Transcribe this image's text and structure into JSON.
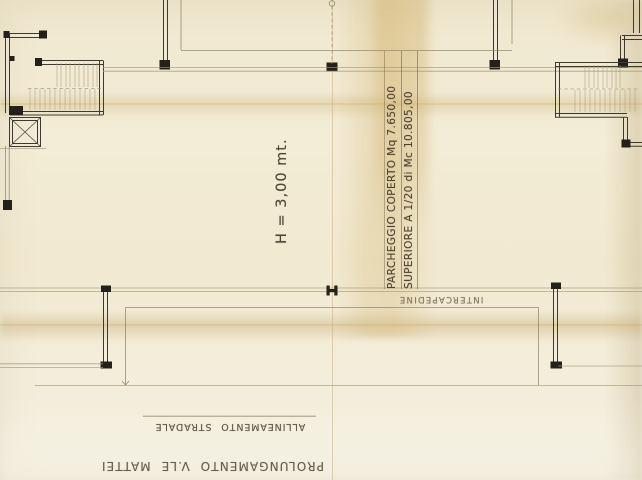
{
  "annotations": {
    "height_note": "H = 3,00 mt.",
    "parking_note": {
      "line1": "PARCHEGGIO COPERTO Mq 7.650,00",
      "line2": "SUPERIORE A 1/20 di Mc 10.805,00"
    },
    "cavity_label": "INTERCAPEDINE",
    "street_alignment_label": "ALLINEAMENTO STRADALE",
    "extension_label": "PROLUNGAMENTO V.LE MATTEI"
  },
  "colors": {
    "paper": "#f2ebd4",
    "ink": "#3c3a32",
    "ink_dark": "#23211c",
    "pencil": "#a29878",
    "pencil_medium": "#8d8468",
    "handwriting": "#4c4536",
    "stain": "#c9a860"
  }
}
